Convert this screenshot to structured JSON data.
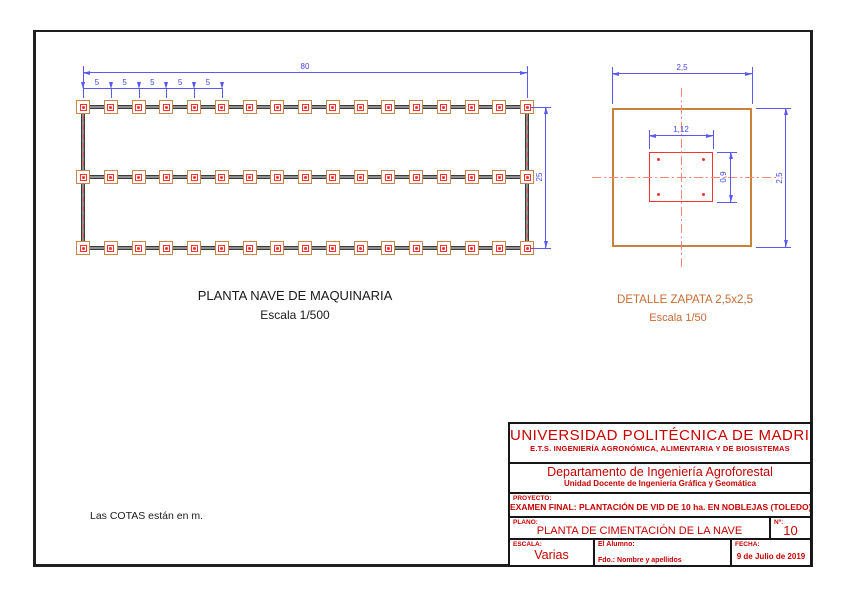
{
  "sheet": {
    "units_note": "Las COTAS están en m.",
    "colors": {
      "dimension_blue": "#5a5af0",
      "drawing_red": "#f93232",
      "centerline_salmon": "#f5897b",
      "footing_tan": "#c8854a",
      "detail_orange": "#c8823c",
      "label_orange": "#c86a32",
      "beam_dark": "#3b3b3b",
      "titleblock_red": "#c80000"
    }
  },
  "plan": {
    "title": "PLANTA NAVE DE MAQUINARIA",
    "scale_label": "Escala 1/500",
    "rows": 3,
    "cols": 17,
    "dim_total_width": "80",
    "dim_bay": "5",
    "bay_dim_count": 5,
    "dim_total_height": "25"
  },
  "detail": {
    "title": "DETALLE ZAPATA 2,5x2,5",
    "scale_label": "Escala 1/50",
    "dim_width": "2,5",
    "dim_height": "2,5",
    "dim_plate_width": "1,12",
    "dim_plate_height": "0,9",
    "anchor_bolts": 4
  },
  "title_block": {
    "university": "UNIVERSIDAD POLITÉCNICA DE MADRID",
    "school": "E.T.S. INGENIERÍA AGRONÓMICA, ALIMENTARIA Y DE BIOSISTEMAS",
    "department": "Departamento de Ingeniería Agroforestal",
    "unit": "Unidad Docente de Ingeniería Gráfica y Geomática",
    "project_label": "PROYECTO:",
    "project": "EXAMEN FINAL: PLANTACIÓN DE VID DE 10 ha. EN NOBLEJAS (TOLEDO).",
    "plan_label": "PLANO:",
    "plan_name": "PLANTA DE CIMENTACIÓN DE LA NAVE",
    "number_label": "Nº:",
    "number": "10",
    "scale_label": "ESCALA:",
    "scale_value": "Varias",
    "student_label": "El Alumno:",
    "student_sign": "Fdo.:    Nombre y apellidos",
    "date_label": "FECHA:",
    "date_value": "9 de Julio de 2019"
  }
}
